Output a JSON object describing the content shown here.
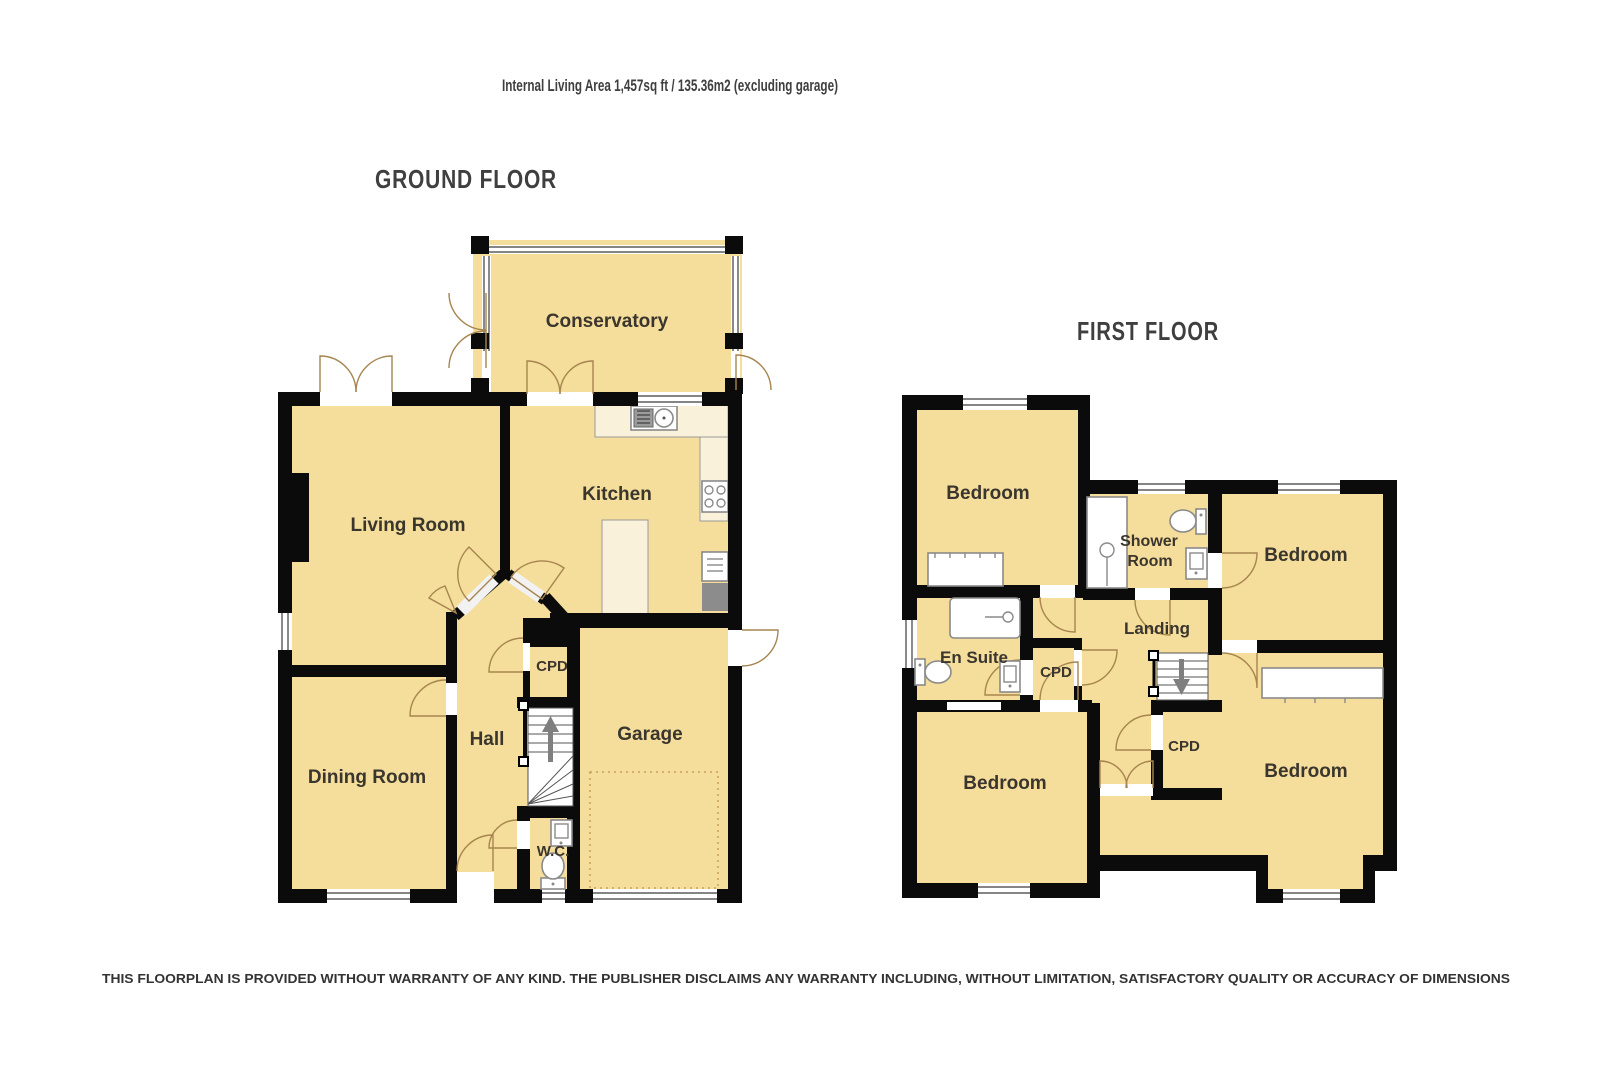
{
  "title": "Internal Living Area 1,457sq ft / 135.36m2 (excluding garage)",
  "disclaimer": "THIS FLOORPLAN IS PROVIDED WITHOUT WARRANTY OF ANY KIND. THE PUBLISHER DISCLAIMS ANY WARRANTY INCLUDING, WITHOUT LIMITATION, SATISFACTORY QUALITY OR ACCURACY OF DIMENSIONS",
  "ground_floor": {
    "heading": "GROUND FLOOR",
    "rooms": {
      "conservatory": "Conservatory",
      "living_room": "Living Room",
      "kitchen": "Kitchen",
      "dining_room": "Dining Room",
      "hall": "Hall",
      "cupboard": "CPD",
      "garage": "Garage",
      "wc": "W.C."
    }
  },
  "first_floor": {
    "heading": "FIRST FLOOR",
    "rooms": {
      "bedroom_front_left": "Bedroom",
      "bedroom_top_right": "Bedroom",
      "bedroom_bottom_left": "Bedroom",
      "bedroom_bottom_right": "Bedroom",
      "en_suite": "En Suite",
      "shower_room_line1": "Shower",
      "shower_room_line2": "Room",
      "landing": "Landing",
      "cupboard_left": "CPD",
      "cupboard_right": "CPD"
    }
  },
  "colors": {
    "room_fill": "#F5DD9B",
    "wall": "#0B0B0B",
    "counter_fill": "#FAF1DB",
    "door_arc": "#A6854F",
    "label_color": "#3A362E",
    "appliance_gray": "#8C8C8C",
    "arrow_gray": "#7F7F7F",
    "dotted_line": "#C9A25A"
  }
}
